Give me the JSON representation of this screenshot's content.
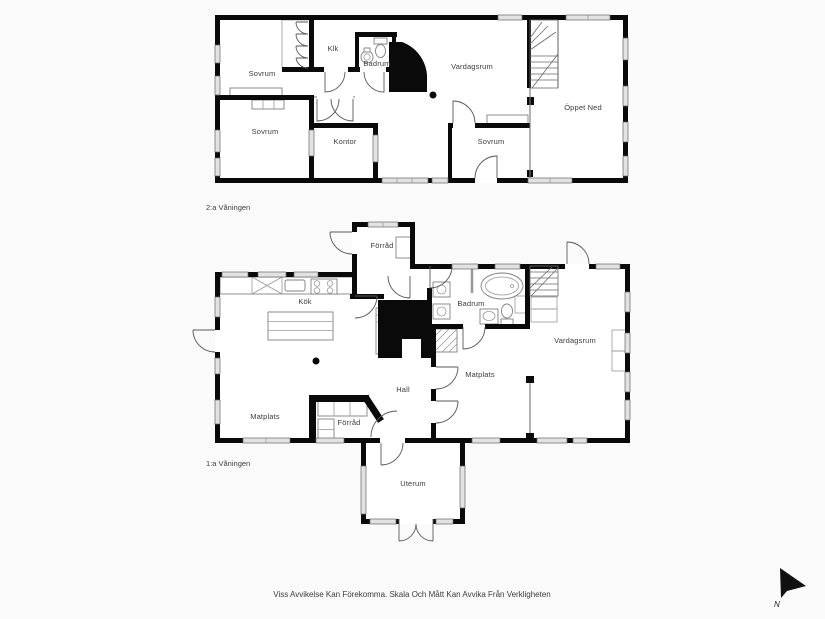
{
  "page": {
    "background": "#fafafa",
    "plan_fill": "#ffffff",
    "wall_color": "#0a0a0a",
    "disclaimer": "Viss Avvikelse Kan Förekomma. Skala Och Mått Kan Avvika Från Verkligheten",
    "compass": {
      "label": "N"
    }
  },
  "floor2": {
    "label": "2:a Våningen",
    "rooms": {
      "sovrum_nw": "Sovrum",
      "klk": "Klk",
      "badrum": "Badrum",
      "vardagsrum": "Vardagsrum",
      "oppet_ned": "Öppet Ned",
      "sovrum_sw": "Sovrum",
      "kontor": "Kontor",
      "sovrum_se": "Sovrum"
    }
  },
  "floor1": {
    "label": "1:a Våningen",
    "rooms": {
      "forrad_n": "Förråd",
      "kok": "Kök",
      "badrum": "Badrum",
      "vardagsrum": "Vardagsrum",
      "matplats": "Matplats",
      "hall": "Hall",
      "matplats_sw": "Matplats",
      "forrad_s": "Förråd",
      "uterum": "Uterum"
    }
  }
}
